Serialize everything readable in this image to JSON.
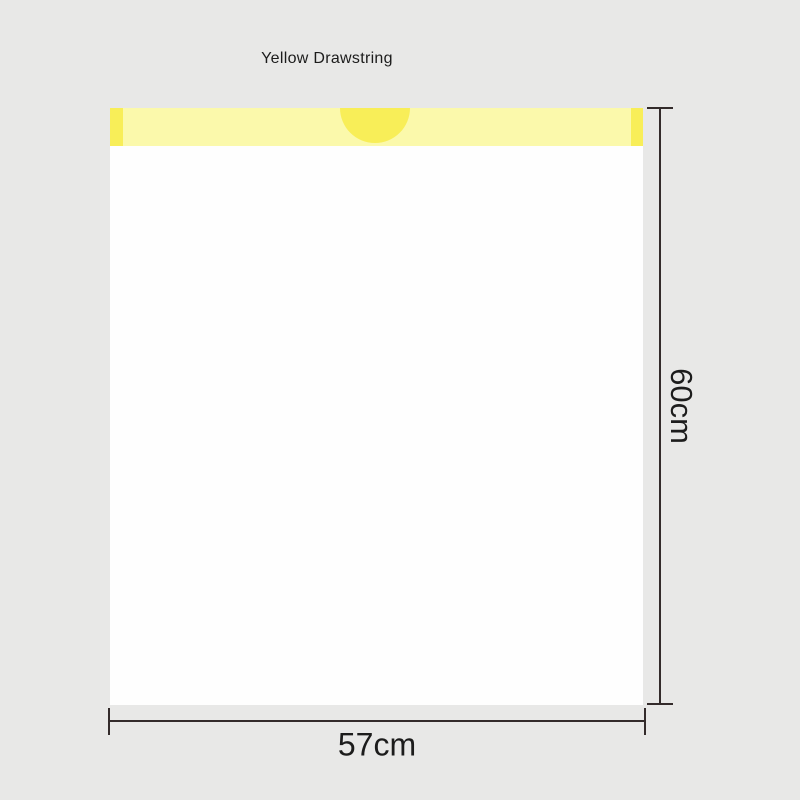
{
  "labels": {
    "drawstring": "Yellow Drawstring",
    "height": "60cm",
    "width": "57cm"
  },
  "colors": {
    "background": "#e8e8e7",
    "bag": "#fefefe",
    "drawstring_band_light": "#fbf9ab",
    "drawstring_band_dark": "#f8ee58",
    "dimension_line": "#332b2b",
    "text": "#1c1c1c"
  }
}
